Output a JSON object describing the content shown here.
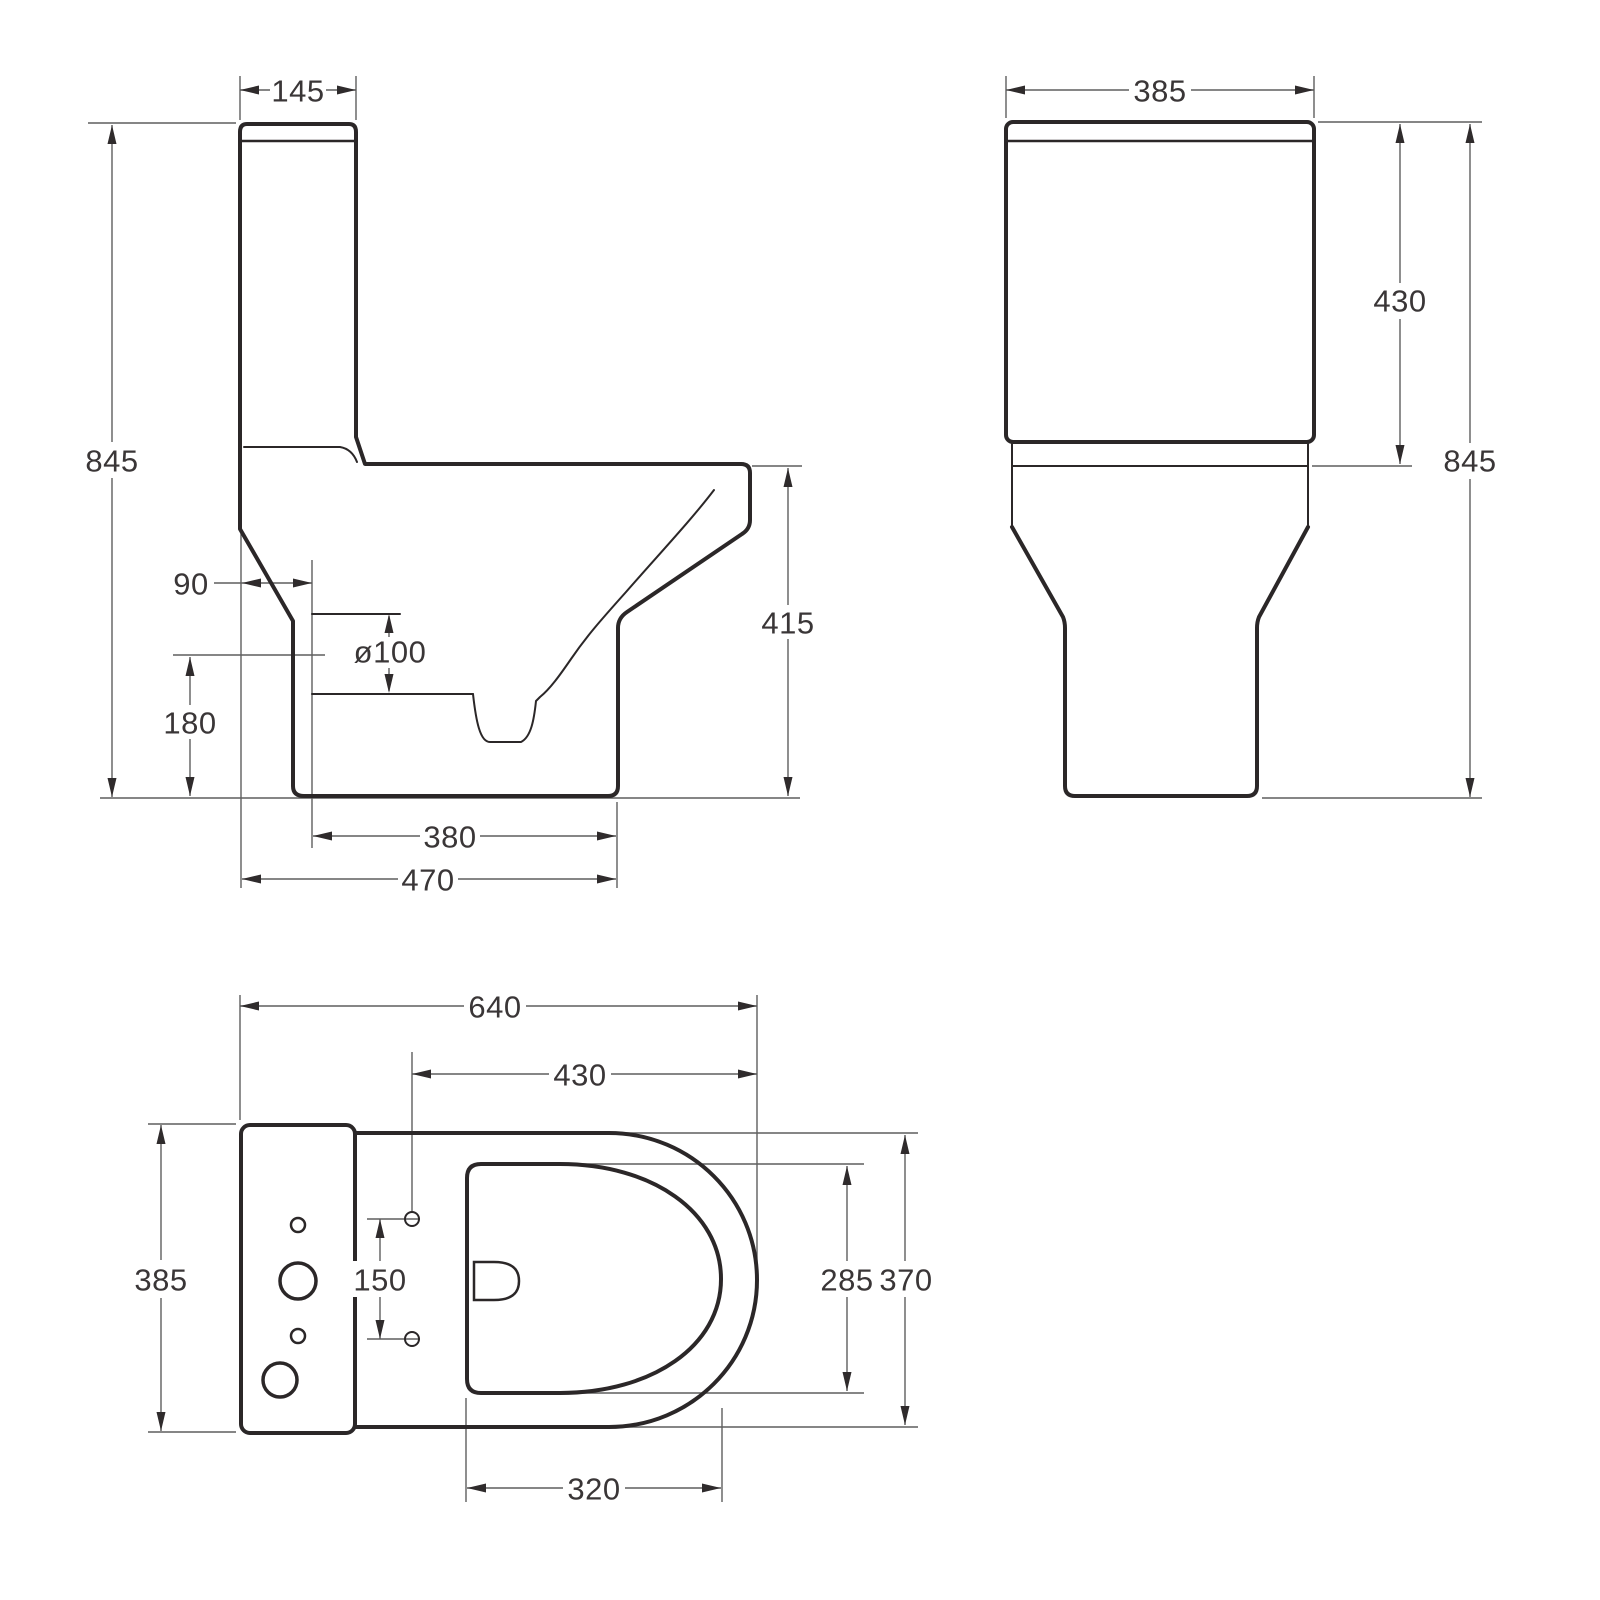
{
  "drawing": {
    "type": "technical-dimension-drawing",
    "subject": "close-coupled toilet, three orthographic views",
    "colors": {
      "background": "#ffffff",
      "outline": "#2b2728",
      "dimension_lines": "#5f5f5f",
      "text": "#3a3637"
    },
    "views": {
      "side": {
        "name": "side elevation",
        "dims": {
          "tank_depth": "145",
          "total_height": "845",
          "outlet_offset": "90",
          "outlet_diameter": "ø100",
          "outlet_height": "180",
          "rim_height": "415",
          "base_depth": "380",
          "overall_depth": "470"
        }
      },
      "front": {
        "name": "front elevation",
        "dims": {
          "tank_width": "385",
          "tank_height": "430",
          "total_height": "845"
        }
      },
      "top": {
        "name": "plan view",
        "dims": {
          "overall_length": "640",
          "bowl_length": "430",
          "tank_width": "385",
          "seat_hole_spacing": "150",
          "seat_inner_width": "285",
          "bowl_width": "370",
          "seat_inner_length": "320"
        }
      }
    }
  }
}
